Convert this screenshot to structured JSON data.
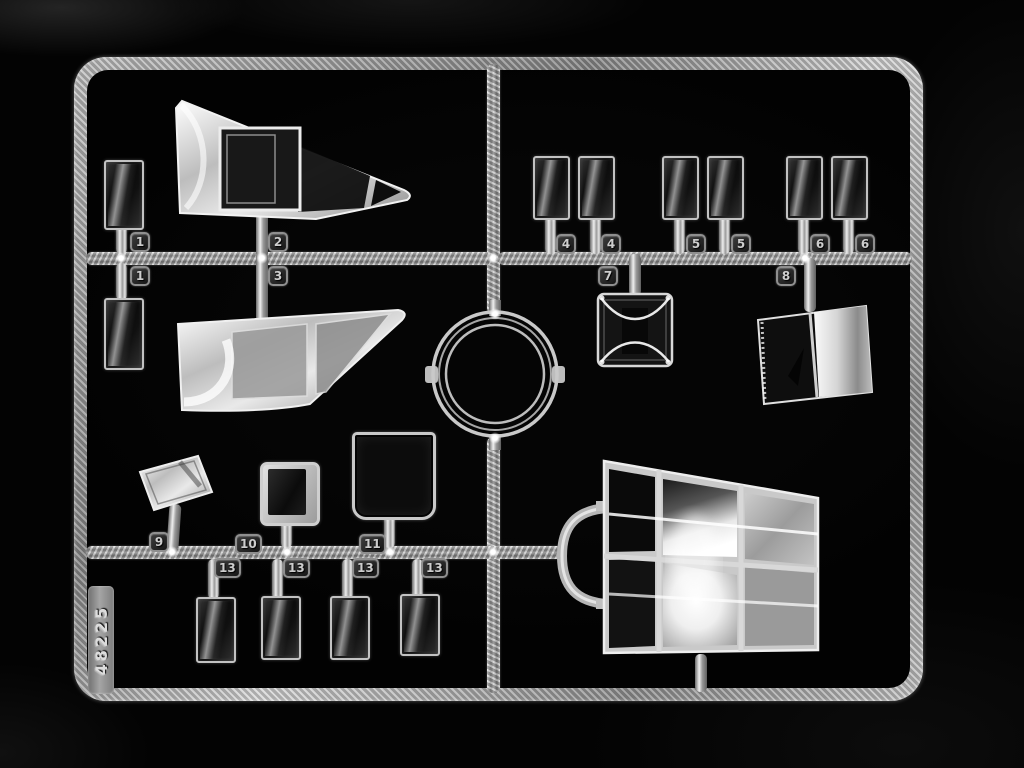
{
  "photo": {
    "subject": "Clear styrene model kit sprue with transparent canopy and window parts photographed on a black background",
    "background_color": "#030303",
    "plastic_color": "#cfcfcf"
  },
  "sprue": {
    "mold_number": "48225",
    "tags": [
      {
        "label": "1"
      },
      {
        "label": "1"
      },
      {
        "label": "2"
      },
      {
        "label": "3"
      },
      {
        "label": "4"
      },
      {
        "label": "4"
      },
      {
        "label": "5"
      },
      {
        "label": "5"
      },
      {
        "label": "6"
      },
      {
        "label": "6"
      },
      {
        "label": "7"
      },
      {
        "label": "8"
      },
      {
        "label": "9"
      },
      {
        "label": "10"
      },
      {
        "label": "11"
      },
      {
        "label": "13"
      },
      {
        "label": "13"
      },
      {
        "label": "13"
      },
      {
        "label": "13"
      }
    ],
    "parts": [
      {
        "tag": "1",
        "name": "small side window rectangle",
        "quantity": 2
      },
      {
        "tag": "2",
        "name": "long tapered canopy glazing (upper)",
        "quantity": 1
      },
      {
        "tag": "3",
        "name": "long tapered canopy glazing (lower)",
        "quantity": 1
      },
      {
        "tag": "4",
        "name": "small cabin window",
        "quantity": 2
      },
      {
        "tag": "5",
        "name": "small cabin window",
        "quantity": 2
      },
      {
        "tag": "6",
        "name": "small cabin window",
        "quantity": 2
      },
      {
        "tag": "7",
        "name": "square clear block with concave faces",
        "quantity": 1
      },
      {
        "tag": "8",
        "name": "two-pane curved windscreen",
        "quantity": 1
      },
      {
        "tag": "9",
        "name": "angled quarter window",
        "quantity": 1
      },
      {
        "tag": "10",
        "name": "small framed square window",
        "quantity": 1
      },
      {
        "tag": "11",
        "name": "large square glazing panel",
        "quantity": 1
      },
      {
        "tag": "13",
        "name": "rectangular window pane",
        "quantity": 4
      },
      {
        "tag": "",
        "name": "clear circular ring",
        "quantity": 1
      },
      {
        "tag": "",
        "name": "multi-pane nose glazing with U-shaped handle runner",
        "quantity": 1
      }
    ]
  }
}
